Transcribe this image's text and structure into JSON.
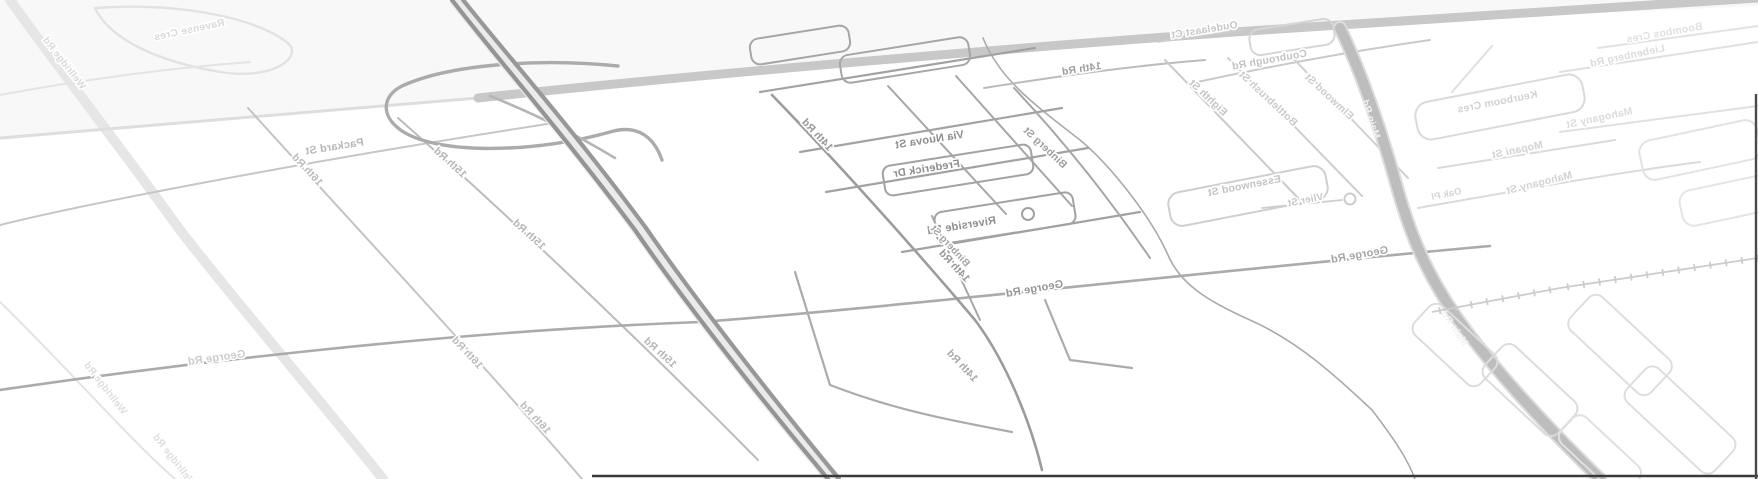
{
  "map": {
    "title": "tilted-mirrored-street-map",
    "background": "#ffffff",
    "halo_color": "#ffffff",
    "tints": [
      {
        "id": "above-top-road",
        "points": "0,0 1758,0 1758,6 1340,25 478,98 0,140",
        "fill": "#f8f8f8"
      }
    ],
    "roads": [
      {
        "id": "pale-left-road",
        "d": "M10,0 C60,70 110,133 180,230 C230,295 320,400 383,479",
        "color": "#e6e6e6",
        "w": 10
      },
      {
        "id": "pale-left-thin",
        "d": "M0,302 C60,360 130,440 175,479",
        "color": "#e3e3e3",
        "w": 2
      },
      {
        "id": "topleft-loop",
        "d": "M95,8 C180,2 260,18 290,45 C300,60 270,80 220,72 C160,62 110,40 95,8",
        "color": "#e2e2e2",
        "w": 2.4
      },
      {
        "id": "topleft-line",
        "d": "M0,95 C80,80 170,68 250,62",
        "color": "#e4e4e4",
        "w": 2
      },
      {
        "id": "top-road-west-faint",
        "d": "M478,98 C340,110 150,125 0,138",
        "color": "#dedede",
        "w": 3
      },
      {
        "id": "top-road",
        "d": "M478,98 C700,74 1100,40 1340,25 C1500,15 1650,5 1758,-2",
        "color": "#c8c8c8",
        "w": 9
      },
      {
        "id": "packard-st",
        "d": "M0,225 C80,205 300,162 560,122",
        "color": "#c6c6c6",
        "w": 2
      },
      {
        "id": "sixteenth-rd",
        "d": "M248,108 C340,210 480,360 582,479",
        "color": "#c4c4c4",
        "w": 2
      },
      {
        "id": "fifteenth-rd",
        "d": "M398,118 C480,190 620,320 758,460",
        "color": "#bcbcbc",
        "w": 2
      },
      {
        "id": "george-rd",
        "d": "M0,390 C150,368 430,332 700,322 C900,307 1200,272 1490,246",
        "color": "#ababab",
        "w": 2.6
      },
      {
        "id": "hwy-loop",
        "d": "M618,66 C540,58 450,64 402,86 C382,96 380,116 402,131 C440,156 540,152 610,132 C640,123 655,140 662,160",
        "color": "#ababab",
        "w": 3.4
      },
      {
        "id": "hwy-ramp",
        "d": "M490,96 C530,112 572,132 615,158",
        "color": "#b5b5b5",
        "w": 2.6
      },
      {
        "id": "highway-casing",
        "d": "M457,0 C505,62 566,130 640,230 C695,310 775,410 833,479",
        "color": "#ebebeb",
        "w": 15
      },
      {
        "id": "highway-a",
        "d": "M452,0 C500,62 560,130 635,230 C690,310 770,410 828,479",
        "color": "#949494",
        "w": 4.2
      },
      {
        "id": "highway-b",
        "d": "M463,0 C511,60 572,128 646,228 C701,308 781,408 839,479",
        "color": "#989898",
        "w": 4.2
      },
      {
        "id": "river",
        "d": "M983,38 C1000,80 1035,105 1080,140 C1110,165 1150,215 1168,255 C1180,283 1205,300 1250,320 C1300,342 1340,380 1372,410 C1395,440 1408,460 1415,479",
        "color": "#aaaaaa",
        "w": 1.6
      },
      {
        "id": "fourteenth-rd-center",
        "d": "M772,95 C840,165 920,255 975,320 C1005,360 1030,420 1042,470",
        "color": "#9c9c9c",
        "w": 2.6
      },
      {
        "id": "grid-top",
        "d": "M760,92 L1035,48",
        "color": "#a2a2a2",
        "w": 2.2
      },
      {
        "id": "via-nuova-st-road",
        "d": "M800,152 L1062,108",
        "color": "#a2a2a2",
        "w": 2.2
      },
      {
        "id": "frederick-dr-road",
        "d": "M826,192 L1088,148",
        "color": "#a2a2a2",
        "w": 2.2
      },
      {
        "id": "riverside-rd-road",
        "d": "M902,252 L1140,212",
        "color": "#a2a2a2",
        "w": 2.2
      },
      {
        "id": "grid-v2",
        "d": "M888,86 L1006,214",
        "color": "#a6a6a6",
        "w": 2
      },
      {
        "id": "grid-v3",
        "d": "M956,76 L1072,206",
        "color": "#a6a6a6",
        "w": 2
      },
      {
        "id": "binberg-st-road",
        "d": "M1014,88 C1070,148 1110,200 1150,258",
        "color": "#a6a6a6",
        "w": 2
      },
      {
        "id": "binberg-lower",
        "d": "M932,216 L980,320",
        "color": "#a6a6a6",
        "w": 2
      },
      {
        "id": "below-george-l1",
        "d": "M795,272 L830,385 C900,412 960,422 1012,432",
        "color": "#ababab",
        "w": 2.2
      },
      {
        "id": "below-george-l2",
        "d": "M1045,300 L1070,360 L1132,368",
        "color": "#ababab",
        "w": 2.2
      },
      {
        "id": "fourteenth-rd-top",
        "d": "M984,88 C1060,76 1130,66 1205,60",
        "color": "#bbbbbb",
        "w": 2
      },
      {
        "id": "coubrough-rd",
        "d": "M1188,84 C1280,64 1360,50 1430,40",
        "color": "#c9c9c9",
        "w": 2
      },
      {
        "id": "oudelaast-ct-road",
        "d": "M1158,42 L1242,30",
        "color": "#cecece",
        "w": 1.8
      },
      {
        "id": "eighth-st-road",
        "d": "M1165,60 L1300,200",
        "color": "#cacaca",
        "w": 2
      },
      {
        "id": "bottlebrush-st-road",
        "d": "M1228,58 L1362,196",
        "color": "#cecece",
        "w": 2
      },
      {
        "id": "elmwood-st-road",
        "d": "M1290,55 L1408,178",
        "color": "#d1d1d1",
        "w": 2
      },
      {
        "id": "vlier-st-road",
        "d": "M1262,208 L1342,200",
        "color": "#cecece",
        "w": 1.8
      },
      {
        "id": "main-rd-casing",
        "d": "M1340,28 C1360,70 1378,120 1395,180 C1410,235 1425,270 1455,315 C1490,365 1540,420 1600,479",
        "color": "#dcdcdc",
        "w": 14
      },
      {
        "id": "main-rd",
        "d": "M1340,28 C1360,70 1378,120 1395,180 C1410,235 1425,270 1455,315 C1490,365 1540,420 1600,479",
        "color": "#bdbdbd",
        "w": 10
      },
      {
        "id": "mopani-st-road",
        "d": "M1438,168 L1615,140",
        "color": "#dadada",
        "w": 2
      },
      {
        "id": "mahogany-st-road",
        "d": "M1418,208 C1520,190 1620,172 1700,162",
        "color": "#dadada",
        "w": 2
      },
      {
        "id": "mahogany-right-road",
        "d": "M1560,132 L1758,106",
        "color": "#e0e0e0",
        "w": 2
      },
      {
        "id": "liebenberg-rd-road",
        "d": "M1560,72 L1758,42",
        "color": "#e0e0e0",
        "w": 2
      },
      {
        "id": "boombos-cres-road",
        "d": "M1598,48 L1758,26",
        "color": "#e2e2e2",
        "w": 2
      },
      {
        "id": "right-connector",
        "d": "M1452,92 L1492,46",
        "color": "#e0e0e0",
        "w": 2
      }
    ],
    "blocks": [
      {
        "id": "grid-block-1",
        "cx": 800,
        "cy": 45,
        "w": 100,
        "h": 26,
        "rot": -9,
        "color": "#a6a6a6",
        "sw": 2,
        "rx": 9
      },
      {
        "id": "grid-block-2",
        "cx": 905,
        "cy": 60,
        "w": 130,
        "h": 28,
        "rot": -9,
        "color": "#a6a6a6",
        "sw": 2,
        "rx": 9
      },
      {
        "id": "grid-block-3",
        "cx": 958,
        "cy": 170,
        "w": 150,
        "h": 30,
        "rot": -9,
        "color": "#a2a2a2",
        "sw": 2,
        "rx": 8
      },
      {
        "id": "grid-block-4",
        "cx": 1005,
        "cy": 218,
        "w": 140,
        "h": 32,
        "rot": -9,
        "color": "#a2a2a2",
        "sw": 2,
        "rx": 8
      },
      {
        "id": "essenwood-loop",
        "cx": 1248,
        "cy": 196,
        "w": 160,
        "h": 34,
        "rot": -11,
        "color": "#cfcfcf",
        "sw": 2,
        "rx": 12
      },
      {
        "id": "keurboom-loop",
        "cx": 1500,
        "cy": 107,
        "w": 170,
        "h": 38,
        "rot": -11,
        "color": "#dadada",
        "sw": 2,
        "rx": 14
      },
      {
        "id": "oudelaast-block",
        "cx": 1292,
        "cy": 37,
        "w": 85,
        "h": 26,
        "rot": -9,
        "color": "#d6d6d6",
        "sw": 2,
        "rx": 10
      },
      {
        "id": "br-block-1",
        "cx": 1455,
        "cy": 345,
        "w": 90,
        "h": 40,
        "rot": 43,
        "color": "#dcdcdc",
        "sw": 2,
        "rx": 10
      },
      {
        "id": "br-block-2",
        "cx": 1530,
        "cy": 390,
        "w": 100,
        "h": 44,
        "rot": 43,
        "color": "#dcdcdc",
        "sw": 2,
        "rx": 10
      },
      {
        "id": "br-block-3",
        "cx": 1620,
        "cy": 345,
        "w": 110,
        "h": 46,
        "rot": 43,
        "color": "#dedede",
        "sw": 2,
        "rx": 10
      },
      {
        "id": "br-block-4",
        "cx": 1680,
        "cy": 420,
        "w": 120,
        "h": 46,
        "rot": 43,
        "color": "#dedede",
        "sw": 2,
        "rx": 10
      },
      {
        "id": "br-block-5",
        "cx": 1600,
        "cy": 455,
        "w": 90,
        "h": 36,
        "rot": 43,
        "color": "#e0e0e0",
        "sw": 2,
        "rx": 10
      },
      {
        "id": "tr-block-1",
        "cx": 1700,
        "cy": 150,
        "w": 120,
        "h": 40,
        "rot": -12,
        "color": "#e2e2e2",
        "sw": 2,
        "rx": 12
      },
      {
        "id": "tr-block-2",
        "cx": 1730,
        "cy": 200,
        "w": 100,
        "h": 36,
        "rot": -12,
        "color": "#e4e4e4",
        "sw": 2,
        "rx": 12
      }
    ],
    "circles": [
      {
        "id": "culdesac-grid",
        "cx": 1028,
        "cy": 214,
        "r": 6,
        "color": "#a2a2a2",
        "sw": 2
      },
      {
        "id": "culdesac-vlier",
        "cx": 1350,
        "cy": 199,
        "r": 5.5,
        "color": "#cccccc",
        "sw": 2
      }
    ],
    "railways": [
      {
        "id": "railway-east",
        "pts": [
          [
            1432,
            312
          ],
          [
            1560,
            288
          ],
          [
            1758,
            258
          ]
        ],
        "color": "#cccccc",
        "w": 1.8,
        "tick": 7,
        "step": 16
      }
    ],
    "edges": [
      {
        "id": "map-edge-bottom",
        "x1": 592,
        "y1": 476,
        "x2": 1758,
        "y2": 476,
        "color": "#3a3a3a",
        "w": 2.4
      },
      {
        "id": "map-edge-right",
        "x1": 1756,
        "y1": 94,
        "x2": 1756,
        "y2": 479,
        "color": "#4a4a4a",
        "w": 2.4
      }
    ],
    "labels": [
      {
        "text": "Via Nuova St",
        "x": 930,
        "y": 143,
        "rot": -9,
        "size": 11,
        "color": "#8e8e8e"
      },
      {
        "text": "Frederick Dr",
        "x": 927,
        "y": 172,
        "rot": -9,
        "size": 11,
        "color": "#8e8e8e"
      },
      {
        "text": "Riverside Rd",
        "x": 962,
        "y": 229,
        "rot": -9,
        "size": 11,
        "color": "#8e8e8e"
      },
      {
        "text": "14th Rd",
        "x": 815,
        "y": 137,
        "rot": 47,
        "size": 10.5,
        "color": "#979797"
      },
      {
        "text": "14th Rd",
        "x": 952,
        "y": 268,
        "rot": 47,
        "size": 10.5,
        "color": "#979797"
      },
      {
        "text": "14th Rd",
        "x": 960,
        "y": 368,
        "rot": 47,
        "size": 10.5,
        "color": "#a8a8a8"
      },
      {
        "text": "14th Rd",
        "x": 1082,
        "y": 72,
        "rot": -9,
        "size": 10.5,
        "color": "#9e9e9e"
      },
      {
        "text": "Binberg St",
        "x": 1043,
        "y": 150,
        "rot": 43,
        "size": 10.5,
        "color": "#9e9e9e"
      },
      {
        "text": "Binberg St",
        "x": 948,
        "y": 248,
        "rot": 47,
        "size": 10,
        "color": "#a5a5a5"
      },
      {
        "text": "George Rd",
        "x": 1035,
        "y": 292,
        "rot": -10,
        "size": 11,
        "color": "#949494"
      },
      {
        "text": "George Rd",
        "x": 1360,
        "y": 258,
        "rot": -10,
        "size": 11,
        "color": "#a5a5a5"
      },
      {
        "text": "George Rd",
        "x": 217,
        "y": 361,
        "rot": -8,
        "size": 11,
        "color": "#cccccc"
      },
      {
        "text": "15th Rd",
        "x": 448,
        "y": 165,
        "rot": 42,
        "size": 10.5,
        "color": "#b5b5b5"
      },
      {
        "text": "15th Rd",
        "x": 527,
        "y": 237,
        "rot": 42,
        "size": 10.5,
        "color": "#b5b5b5"
      },
      {
        "text": "15th Rd",
        "x": 658,
        "y": 355,
        "rot": 42,
        "size": 10.5,
        "color": "#b5b5b5"
      },
      {
        "text": "16th Rd",
        "x": 305,
        "y": 172,
        "rot": 47,
        "size": 10.5,
        "color": "#bbbbbb"
      },
      {
        "text": "16th Rd",
        "x": 465,
        "y": 355,
        "rot": 47,
        "size": 10.5,
        "color": "#bbbbbb"
      },
      {
        "text": "16th Rd",
        "x": 533,
        "y": 420,
        "rot": 47,
        "size": 10.5,
        "color": "#bbbbbb"
      },
      {
        "text": "Packard St",
        "x": 335,
        "y": 150,
        "rot": -9,
        "size": 11,
        "color": "#b8b8b8"
      },
      {
        "text": "Eighth St",
        "x": 1206,
        "y": 100,
        "rot": 43,
        "size": 10.5,
        "color": "#c3c3c3"
      },
      {
        "text": "Bottlebrush St",
        "x": 1266,
        "y": 101,
        "rot": 43,
        "size": 10.5,
        "color": "#c9c9c9"
      },
      {
        "text": "Elmwood St",
        "x": 1327,
        "y": 99,
        "rot": 43,
        "size": 10.5,
        "color": "#cccccc"
      },
      {
        "text": "Coubrough Rd",
        "x": 1270,
        "y": 63,
        "rot": -10,
        "size": 10.5,
        "color": "#c3c3c3"
      },
      {
        "text": "Oudelaast Ct",
        "x": 1205,
        "y": 33,
        "rot": -9,
        "size": 10.5,
        "color": "#c7c7c7"
      },
      {
        "text": "Essenwood St",
        "x": 1245,
        "y": 189,
        "rot": -11,
        "size": 10.5,
        "color": "#c3c3c3"
      },
      {
        "text": "Vlier St",
        "x": 1306,
        "y": 203,
        "rot": -11,
        "size": 10,
        "color": "#c7c7c7"
      },
      {
        "text": "Main Rd",
        "x": 1368,
        "y": 120,
        "rot": 72,
        "size": 10,
        "color": "#f2f2f2",
        "halo": false
      },
      {
        "text": "Main Rd",
        "x": 1452,
        "y": 330,
        "rot": 55,
        "size": 10,
        "color": "#f2f2f2",
        "halo": false
      },
      {
        "text": "Keurboom Cres",
        "x": 1498,
        "y": 105,
        "rot": -11,
        "size": 10.5,
        "color": "#d2d2d2"
      },
      {
        "text": "Mopani St",
        "x": 1518,
        "y": 153,
        "rot": -12,
        "size": 10.5,
        "color": "#d2d2d2"
      },
      {
        "text": "Mahogany St",
        "x": 1540,
        "y": 186,
        "rot": -14,
        "size": 10.5,
        "color": "#d2d2d2"
      },
      {
        "text": "Oak Pl",
        "x": 1447,
        "y": 197,
        "rot": -12,
        "size": 9.5,
        "color": "#d6d6d6"
      },
      {
        "text": "Mahogany St",
        "x": 1600,
        "y": 121,
        "rot": -12,
        "size": 10.5,
        "color": "#dcdcdc"
      },
      {
        "text": "Liebenberg Rd",
        "x": 1628,
        "y": 59,
        "rot": -12,
        "size": 10.5,
        "color": "#dcdcdc"
      },
      {
        "text": "Boombos Cres",
        "x": 1665,
        "y": 36,
        "rot": -10,
        "size": 10.5,
        "color": "#e0e0e0"
      },
      {
        "text": "Ravense Cres",
        "x": 190,
        "y": 33,
        "rot": -12,
        "size": 10.5,
        "color": "#dadada"
      },
      {
        "text": "Wellridge Rd",
        "x": 62,
        "y": 65,
        "rot": 52,
        "size": 10,
        "color": "#dadada"
      },
      {
        "text": "Wellridge Rd",
        "x": 103,
        "y": 390,
        "rot": 52,
        "size": 10,
        "color": "#dedede"
      },
      {
        "text": "Wellridge Rd",
        "x": 172,
        "y": 462,
        "rot": 52,
        "size": 10,
        "color": "#dedede"
      }
    ]
  }
}
